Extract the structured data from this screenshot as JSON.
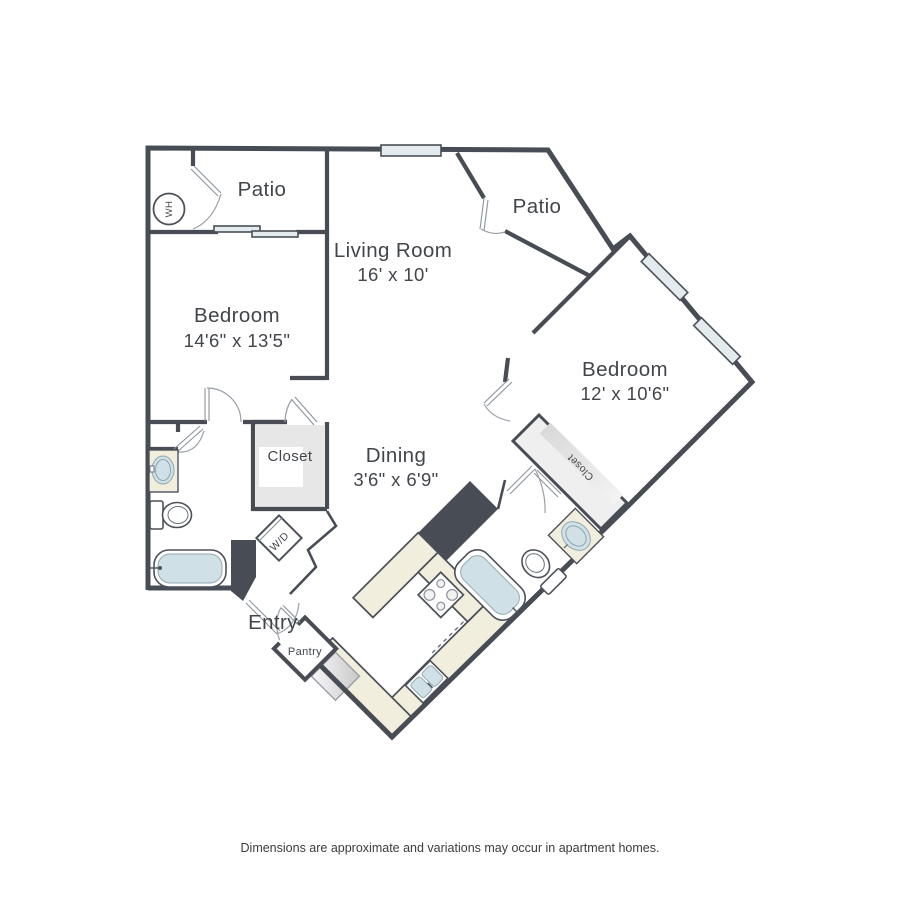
{
  "meta": {
    "footer": "Dimensions are approximate and variations may occur in apartment homes."
  },
  "rooms": {
    "patio_left": {
      "label": "Patio"
    },
    "patio_right": {
      "label": "Patio"
    },
    "living": {
      "label": "Living Room",
      "dims": "16' x 10'"
    },
    "bedroom_left": {
      "label": "Bedroom",
      "dims": "14'6\" x 13'5\""
    },
    "bedroom_right": {
      "label": "Bedroom",
      "dims": "12' x 10'6\""
    },
    "dining": {
      "label": "Dining",
      "dims": "3'6\" x 6'9\""
    },
    "closet_left": {
      "label": "Closet"
    },
    "closet_right": {
      "label": "Closet"
    },
    "entry": {
      "label": "Entry"
    },
    "pantry": {
      "label": "Pantry"
    },
    "washer_dryer": {
      "label": "W/D"
    },
    "water_heater": {
      "label": "WH"
    }
  },
  "colors": {
    "wall": "#484d55",
    "counter": "#f1eedd",
    "fixture": "#cfe0e6",
    "window": "#e4ebee",
    "shelf": "#e7e7e7",
    "text": "#42464b"
  }
}
